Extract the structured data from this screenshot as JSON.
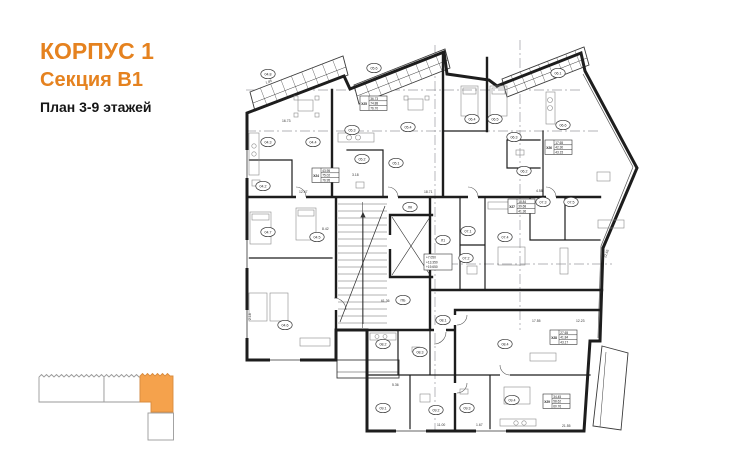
{
  "header": {
    "title": "КОРПУС 1",
    "subtitle": "Секция В1",
    "caption": "План 3-9 этажей"
  },
  "colors": {
    "accent": "#E5821F",
    "key_highlight": "#F5A24C",
    "key_highlight_stroke": "#D98C3F"
  },
  "plan": {
    "room_tags": [
      "04.8",
      "04.3",
      "04.4",
      "04.2",
      "04.7",
      "04.5",
      "04.6",
      "05.6",
      "05.3",
      "05.4",
      "05.2",
      "05.1",
      "06.1",
      "06.4",
      "06.5",
      "06.3",
      "06.6",
      "06.2",
      "07.1",
      "07.2",
      "07.4",
      "07.3",
      "07.5",
      "ЛК",
      "Л1",
      "ПБ",
      "08.2",
      "08.3",
      "08.1",
      "08.4",
      "09.1",
      "09.2",
      "09.3",
      "09.4"
    ],
    "apartment_tables": [
      {
        "id": "X24",
        "values": [
          "43.95",
          "75.02",
          "76.95"
        ]
      },
      {
        "id": "X25",
        "values": [
          "36.73",
          "74.88",
          "76.70"
        ]
      },
      {
        "id": "X26",
        "values": [
          "17.65",
          "42.30",
          "43.15"
        ]
      },
      {
        "id": "X27",
        "values": [
          "18.84",
          "39.68",
          "41.36"
        ]
      },
      {
        "id": "X28",
        "values": [
          "27.65",
          "41.84",
          "43.17"
        ]
      },
      {
        "id": "X29",
        "values": [
          "34.45",
          "58.62",
          "60.76"
        ]
      }
    ],
    "levels": [
      "+7.050",
      "+13.350",
      "+19.650"
    ],
    "dims": [
      "12.47",
      "18.71",
      "16.73",
      "5.36",
      "4.58",
      "3.18",
      "2.18",
      "1.67",
      "11.00",
      "17.55",
      "22.65",
      "12.23",
      "61.36",
      "8.42",
      "1.85",
      "21.55"
    ]
  }
}
